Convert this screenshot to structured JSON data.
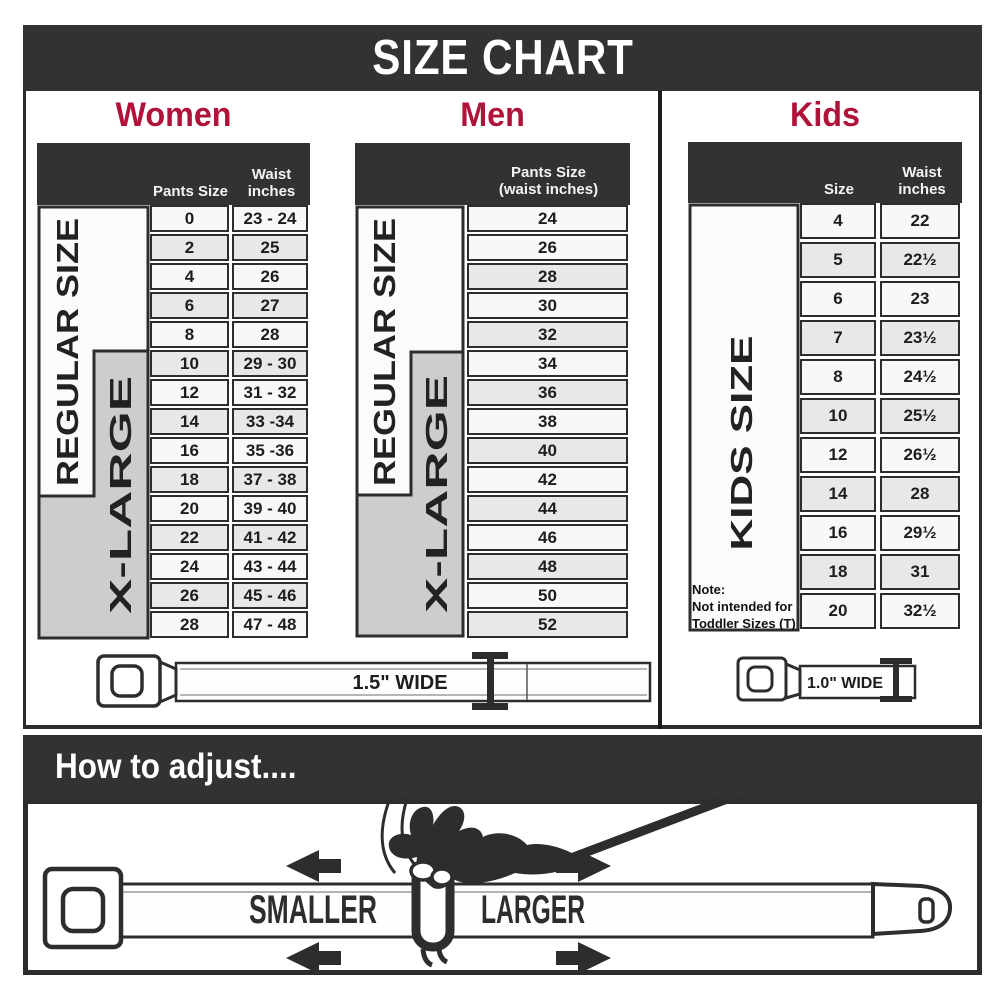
{
  "title": "SIZE CHART",
  "colors": {
    "band_dark": "#323232",
    "accent_red": "#b0123a",
    "row_light": "#f8f8f8",
    "row_shaded": "#e8e8e8",
    "label_box_gray": "#cdcdcd",
    "border_dark": "#2d2d2d"
  },
  "women": {
    "title": "Women",
    "col_pants": "Pants Size",
    "col_waist_l1": "Waist",
    "col_waist_l2": "inches",
    "regular_label": "REGULAR SIZE",
    "xlarge_label": "X-LARGE",
    "rows": [
      {
        "size": "0",
        "waist": "23 - 24",
        "shaded": false
      },
      {
        "size": "2",
        "waist": "25",
        "shaded": true
      },
      {
        "size": "4",
        "waist": "26",
        "shaded": false
      },
      {
        "size": "6",
        "waist": "27",
        "shaded": true
      },
      {
        "size": "8",
        "waist": "28",
        "shaded": false
      },
      {
        "size": "10",
        "waist": "29 - 30",
        "shaded": true
      },
      {
        "size": "12",
        "waist": "31 - 32",
        "shaded": false
      },
      {
        "size": "14",
        "waist": "33 -34",
        "shaded": true
      },
      {
        "size": "16",
        "waist": "35 -36",
        "shaded": false
      },
      {
        "size": "18",
        "waist": "37 - 38",
        "shaded": true
      },
      {
        "size": "20",
        "waist": "39 - 40",
        "shaded": false
      },
      {
        "size": "22",
        "waist": "41 - 42",
        "shaded": true
      },
      {
        "size": "24",
        "waist": "43 - 44",
        "shaded": false
      },
      {
        "size": "26",
        "waist": "45 - 46",
        "shaded": true
      },
      {
        "size": "28",
        "waist": "47 - 48",
        "shaded": false
      }
    ]
  },
  "men": {
    "title": "Men",
    "header_l1": "Pants Size",
    "header_l2": "(waist inches)",
    "regular_label": "REGULAR SIZE",
    "xlarge_label": "X-LARGE",
    "rows": [
      {
        "size": "24",
        "shaded": false
      },
      {
        "size": "26",
        "shaded": false
      },
      {
        "size": "28",
        "shaded": true
      },
      {
        "size": "30",
        "shaded": false
      },
      {
        "size": "32",
        "shaded": true
      },
      {
        "size": "34",
        "shaded": false
      },
      {
        "size": "36",
        "shaded": true
      },
      {
        "size": "38",
        "shaded": false
      },
      {
        "size": "40",
        "shaded": true
      },
      {
        "size": "42",
        "shaded": false
      },
      {
        "size": "44",
        "shaded": true
      },
      {
        "size": "46",
        "shaded": false
      },
      {
        "size": "48",
        "shaded": true
      },
      {
        "size": "50",
        "shaded": false
      },
      {
        "size": "52",
        "shaded": true
      }
    ]
  },
  "kids": {
    "title": "Kids",
    "col_size": "Size",
    "col_waist_l1": "Waist",
    "col_waist_l2": "inches",
    "label": "KIDS SIZE",
    "note_l1": "Note:",
    "note_l2": "Not intended for",
    "note_l3": "Toddler Sizes (T)",
    "rows": [
      {
        "size": "4",
        "waist": "22",
        "shaded": false
      },
      {
        "size": "5",
        "waist": "22½",
        "shaded": true
      },
      {
        "size": "6",
        "waist": "23",
        "shaded": false
      },
      {
        "size": "7",
        "waist": "23½",
        "shaded": true
      },
      {
        "size": "8",
        "waist": "24½",
        "shaded": false
      },
      {
        "size": "10",
        "waist": "25½",
        "shaded": true
      },
      {
        "size": "12",
        "waist": "26½",
        "shaded": false
      },
      {
        "size": "14",
        "waist": "28",
        "shaded": true
      },
      {
        "size": "16",
        "waist": "29½",
        "shaded": false
      },
      {
        "size": "18",
        "waist": "31",
        "shaded": true
      },
      {
        "size": "20",
        "waist": "32½",
        "shaded": false
      }
    ]
  },
  "belts": {
    "adult_label": "1.5\" WIDE",
    "kids_label": "1.0\" WIDE"
  },
  "footer": {
    "title": "How to adjust....",
    "smaller": "SMALLER",
    "larger": "LARGER"
  }
}
